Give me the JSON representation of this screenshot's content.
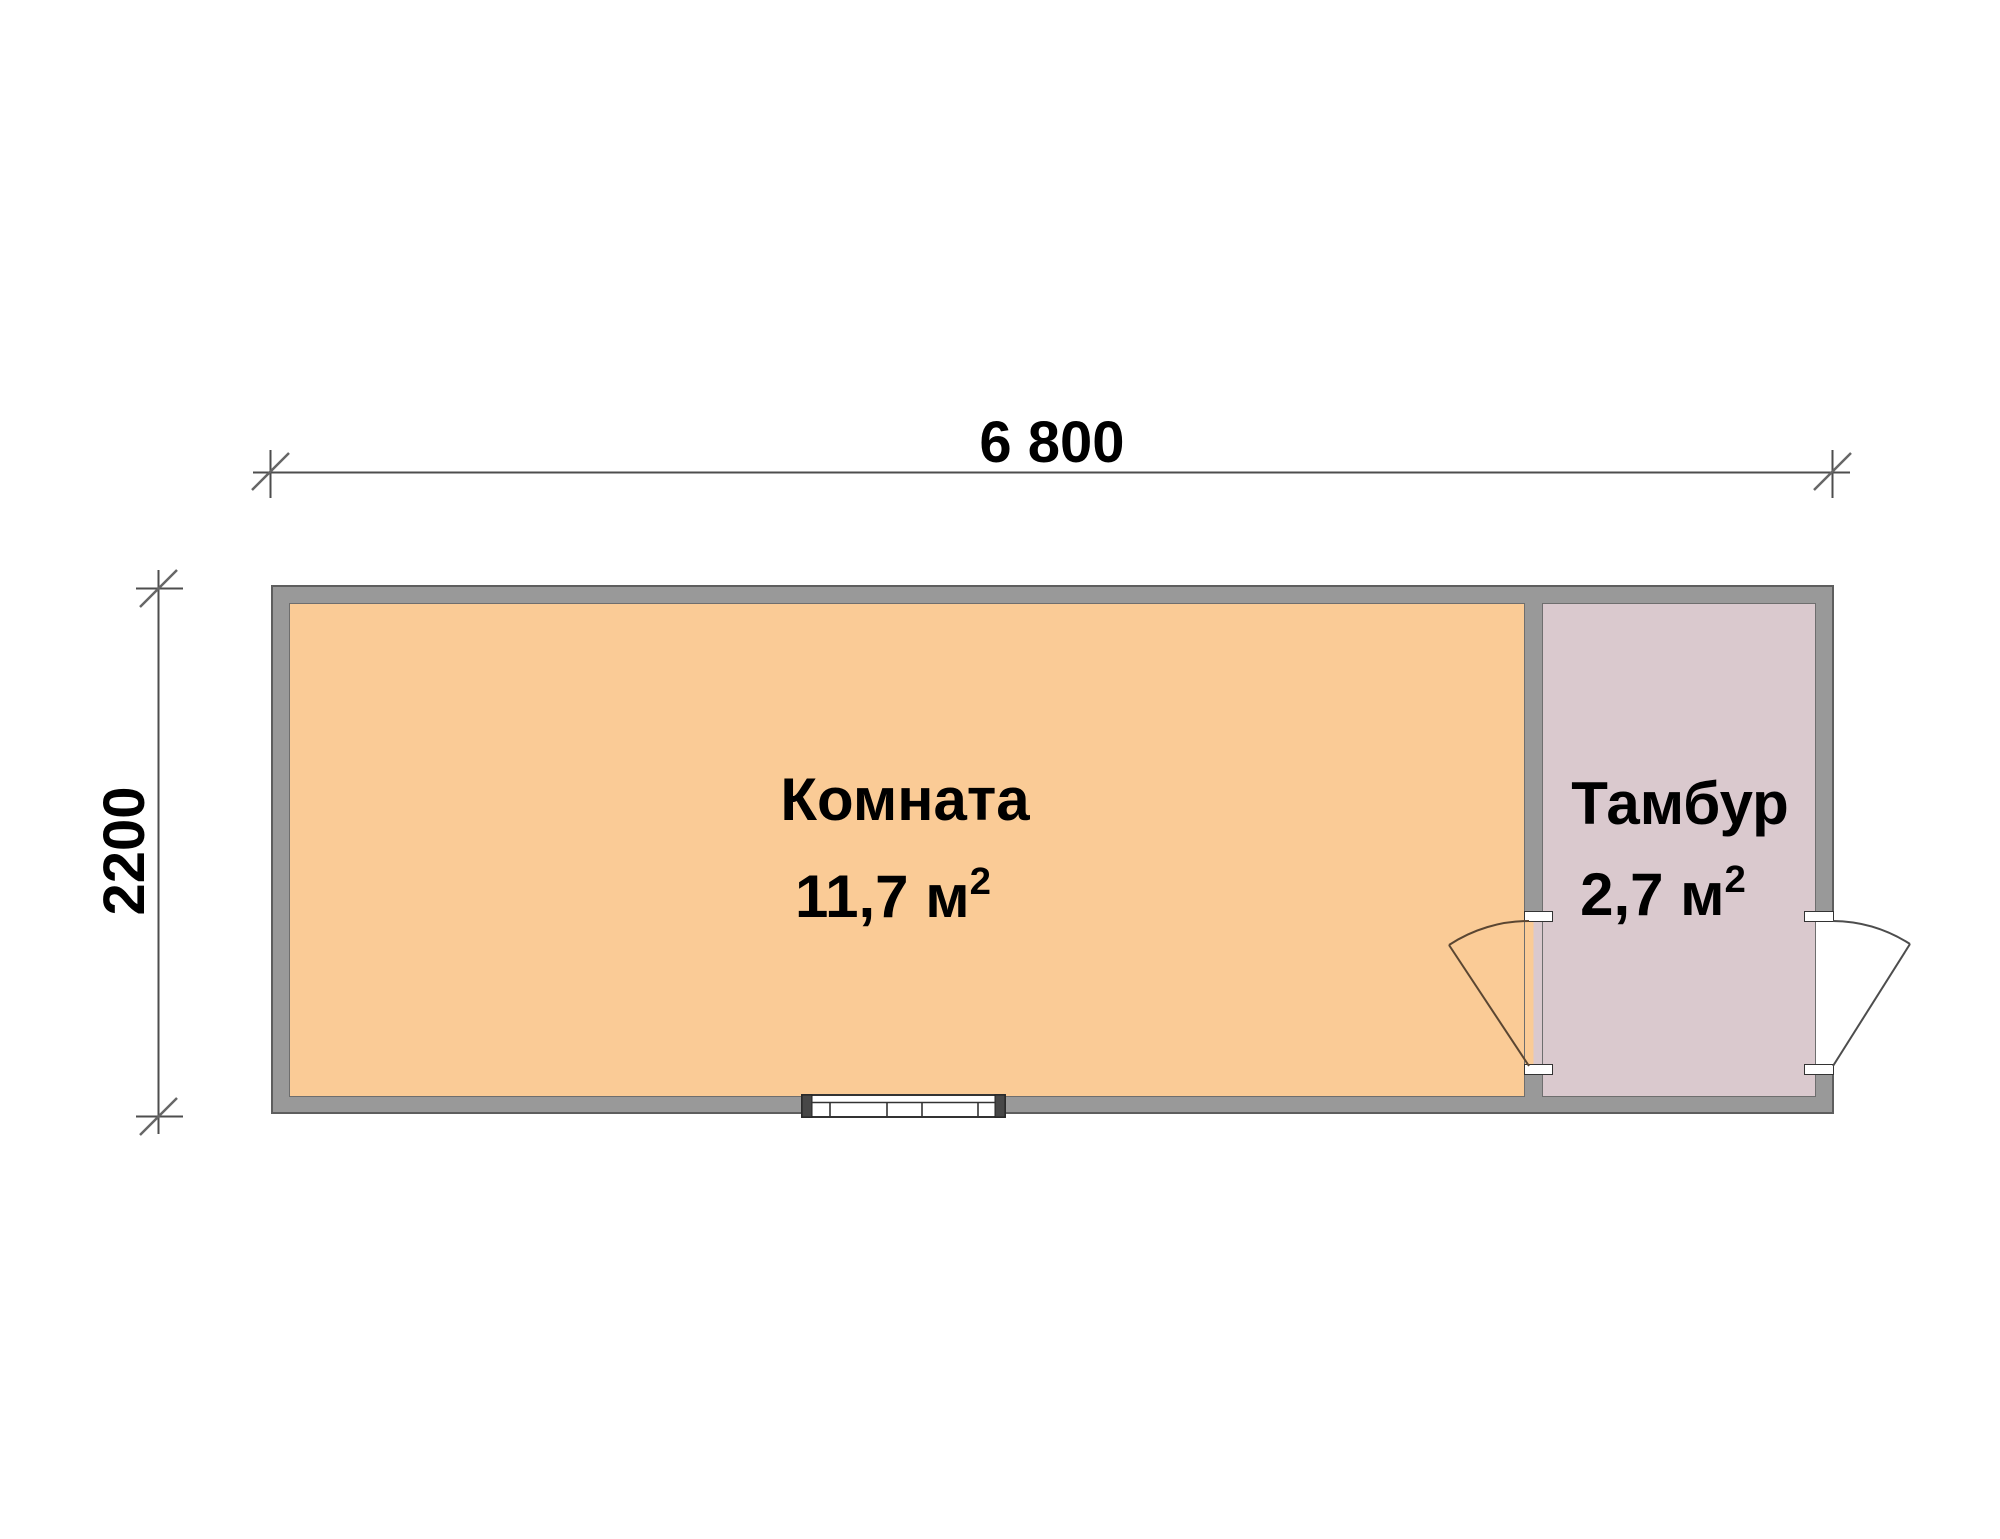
{
  "plan": {
    "title": "floor-plan",
    "dimensions": {
      "width_label": "6 800",
      "height_label": "2200"
    },
    "rooms": [
      {
        "name": "Комната",
        "area": "11,7 м",
        "area_sup": "2"
      },
      {
        "name": "Тамбур",
        "area": "2,7 м",
        "area_sup": "2"
      }
    ],
    "colors": {
      "room1_fill": "#FACB96",
      "room2_fill": "#DAC9CE",
      "wall": "#999999",
      "wall_outline": "#5E5E5E",
      "dim_line": "#4D4D4D",
      "text_color": "#000000"
    }
  }
}
